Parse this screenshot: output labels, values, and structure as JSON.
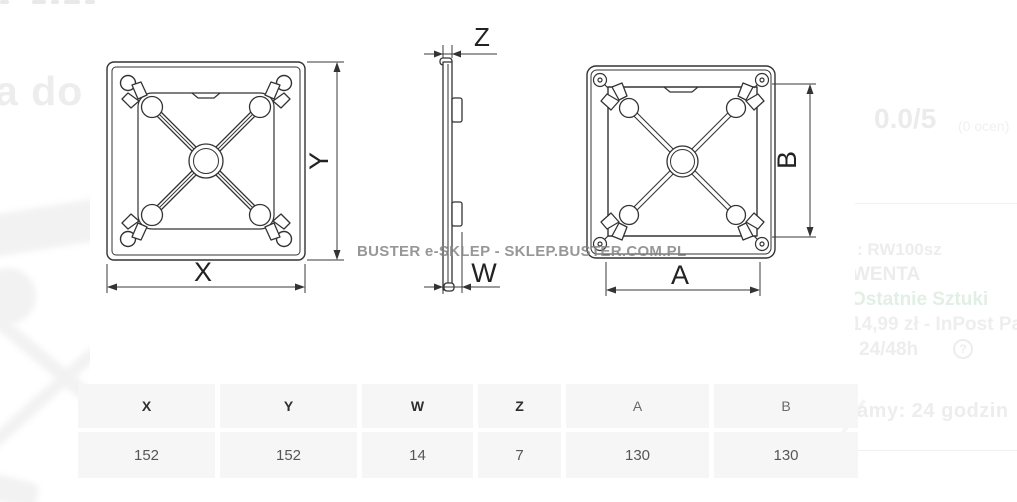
{
  "watermark": "BUSTER e-SKLEP - SKLEP.BUSTER.COM.PL",
  "ghosts": {
    "left_text": "a do"
  },
  "drawing": {
    "labels": {
      "x": "X",
      "y": "Y",
      "z": "Z",
      "w": "W",
      "a": "A",
      "b": "B"
    }
  },
  "side_panel": {
    "rating_score": "0.0/5",
    "rating_count": "(0 ocen)",
    "sku_line": ":  RW100sz",
    "brand_line": "WENTA",
    "stock_line": "Ostatnie Sztuki",
    "shipping_line": "14,99 zł - InPost Paczk",
    "delivery_time_line": "24/48h",
    "help_icon": "?",
    "dispatch_line": "łamy:  24 godzin"
  },
  "dimensions_table": {
    "columns": [
      {
        "header": "X",
        "value": "152"
      },
      {
        "header": "Y",
        "value": "152"
      },
      {
        "header": "W",
        "value": "14"
      },
      {
        "header": "Z",
        "value": "7"
      },
      {
        "header": "A",
        "value": "130"
      },
      {
        "header": "B",
        "value": "130"
      }
    ]
  }
}
